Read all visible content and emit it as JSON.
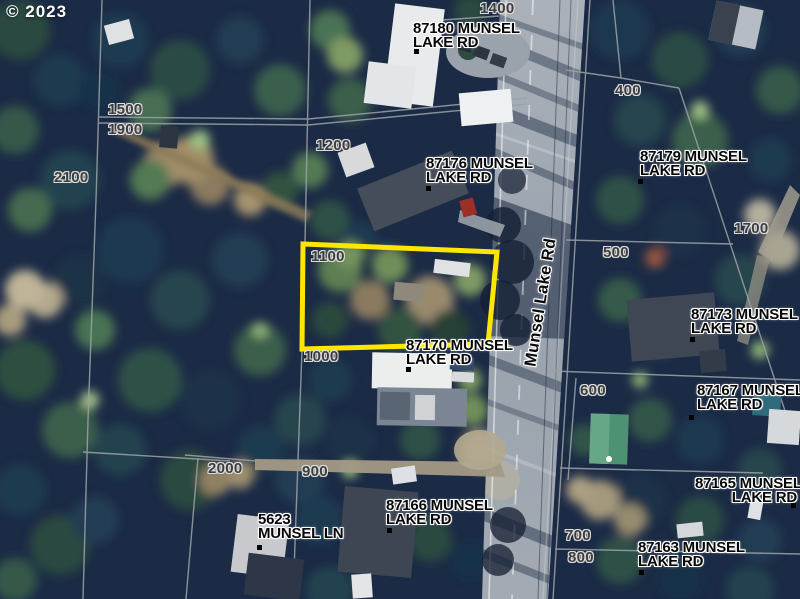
{
  "watermark": "© 2023",
  "road_label": "Munsel Lake Rd",
  "colors": {
    "highlight_outline": "#ffe600"
  },
  "parcel_numbers": {
    "n1400": "1400",
    "n1500": "1500",
    "n1900": "1900",
    "n2100": "2100",
    "n1200": "1200",
    "n1100": "1100",
    "n1000": "1000",
    "n400": "400",
    "n500": "500",
    "n1700": "1700",
    "n600": "600",
    "n700": "700",
    "n800": "800",
    "n900": "900",
    "n2000": "2000"
  },
  "addresses": {
    "a87180": {
      "line1": "87180 MUNSEL",
      "line2": "LAKE RD"
    },
    "a87176": {
      "line1": "87176 MUNSEL",
      "line2": "LAKE RD"
    },
    "a87179": {
      "line1": "87179 MUNSEL",
      "line2": "LAKE RD"
    },
    "a87173": {
      "line1": "87173 MUNSEL",
      "line2": "LAKE RD"
    },
    "a87170": {
      "line1": "87170 MUNSEL",
      "line2": "LAKE RD"
    },
    "a87167": {
      "line1": "87167 MUNSEL",
      "line2": "LAKE RD"
    },
    "a87165": {
      "line1": "87165 MUNSEL",
      "line2": "LAKE RD"
    },
    "a87166": {
      "line1": "87166 MUNSEL",
      "line2": "LAKE RD"
    },
    "a87163": {
      "line1": "87163 MUNSEL",
      "line2": "LAKE RD"
    },
    "a5623": {
      "line1": "5623",
      "line2": "MUNSEL LN"
    }
  }
}
